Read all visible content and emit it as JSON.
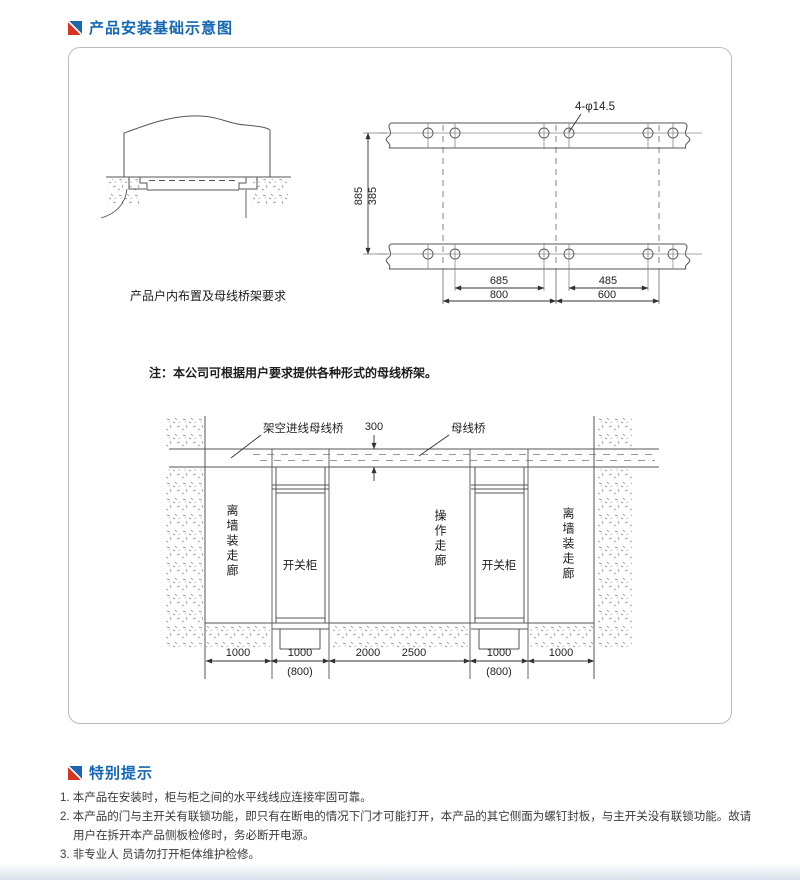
{
  "sections": {
    "install": {
      "title": "产品安装基础示意图"
    },
    "tips": {
      "title": "特别提示"
    }
  },
  "diagram": {
    "detail_caption": "产品户内布置及母线桥架要求",
    "note": "注：本公司可根据用户要求提供各种形式的母线桥架。",
    "plan": {
      "holes_label": "4-φ14.5",
      "dim_v_outer": "885",
      "dim_v_inner": "385",
      "dim_hole_left": "685",
      "dim_hole_right": "485",
      "dim_pitch_left": "800",
      "dim_pitch_right": "600"
    },
    "elevation": {
      "overhead_bus_label": "架空进线母线桥",
      "bus_bridge_label": "母线桥",
      "dim_bridge": "300",
      "corridor_left": "离墙装走廊",
      "corridor_middle": "操作走廊",
      "corridor_right": "离墙装走廊",
      "cabinet_left": "开关柜",
      "cabinet_right": "开关柜",
      "dim_1": "1000",
      "dim_2": "1000",
      "dim_2_alt": "(800)",
      "dim_3a": "2000",
      "dim_3b": "2500",
      "dim_4": "1000",
      "dim_4_alt": "(800)",
      "dim_5": "1000"
    }
  },
  "tips": {
    "notes": [
      {
        "lines": [
          "1. 本产品在安装时，柜与柜之间的水平线线应连接牢固可靠。"
        ]
      },
      {
        "lines": [
          "2. 本产品的门与主开关有联锁功能，即只有在断电的情况下门才可能打开，本产品的其它侧面为螺钉封板，与主开关没有联锁功能。故请",
          "用户在拆开本产品侧板检修时，务必断开电源。"
        ]
      },
      {
        "lines": [
          "3. 非专业人 员请勿打开柜体维护检修。"
        ]
      }
    ]
  },
  "colors": {
    "accent_blue": "#1467b4",
    "accent_red": "#d93423"
  }
}
